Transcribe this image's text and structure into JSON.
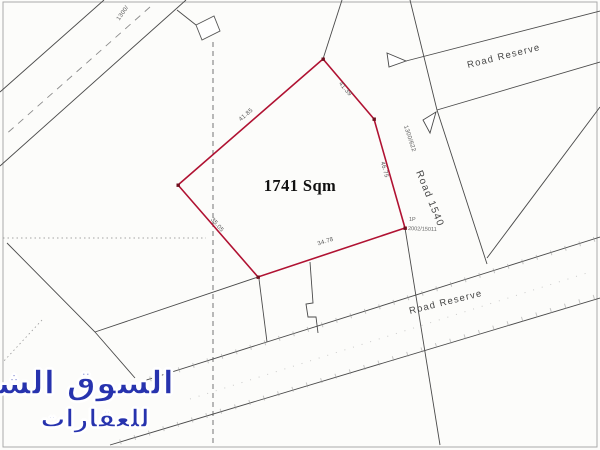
{
  "map": {
    "plot": {
      "area_label": "1741 Sqm",
      "point_label": "1P",
      "point_ref": "2002/15011",
      "dims": {
        "nw": "41.85",
        "ne": "41.39",
        "east": "46.75",
        "south": "34.78",
        "sw": "35.05"
      }
    },
    "roads": {
      "road_1540": "Road 1540",
      "road_1540_ref": "1300/622",
      "reserve_top": "Road Reserve",
      "reserve_bottom": "Road Reserve",
      "top_left_ref": "1300/"
    }
  },
  "watermark": {
    "line1": "السوق الشامل",
    "line2": "للعقارات"
  },
  "colors": {
    "plot_outline": "#b01232",
    "plot_vertex": "#70101f",
    "watermark_blue": "#2733ae"
  }
}
